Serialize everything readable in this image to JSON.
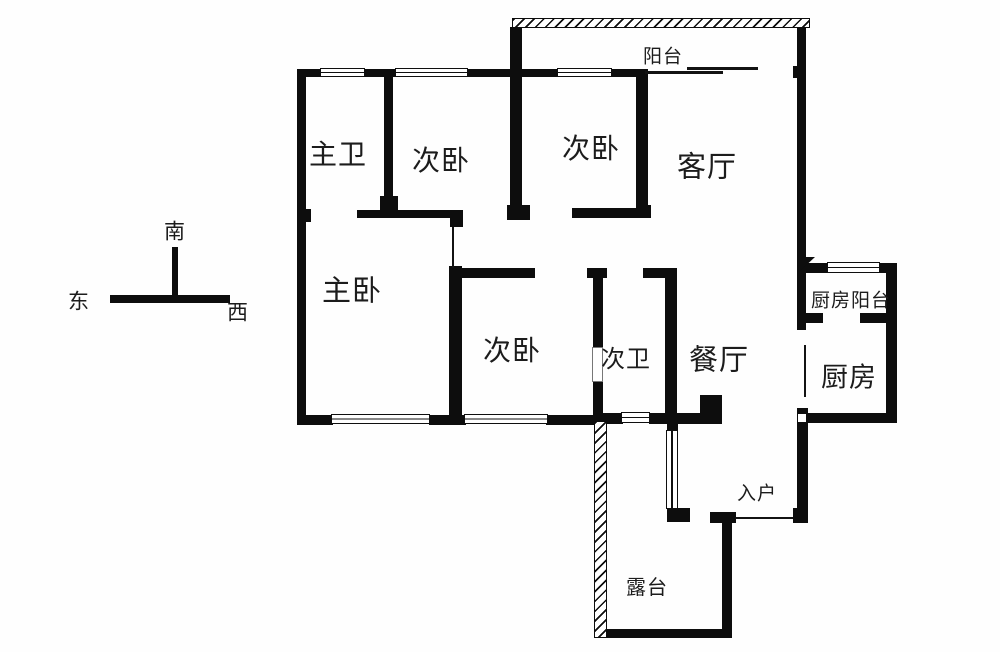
{
  "floorplan": {
    "background_color": "#fefefe",
    "wall_color": "#0d0d0d",
    "rooms": [
      {
        "id": "balcony",
        "label": "阳台",
        "x": 663,
        "y": 57,
        "fs": 19
      },
      {
        "id": "master-bath",
        "label": "主卫",
        "x": 338,
        "y": 156,
        "fs": 28
      },
      {
        "id": "bedroom-1",
        "label": "次卧",
        "x": 441,
        "y": 162,
        "fs": 28
      },
      {
        "id": "bedroom-2",
        "label": "次卧",
        "x": 591,
        "y": 150,
        "fs": 28
      },
      {
        "id": "living-room",
        "label": "客厅",
        "x": 707,
        "y": 168,
        "fs": 29
      },
      {
        "id": "master-bedroom",
        "label": "主卧",
        "x": 352,
        "y": 292,
        "fs": 29
      },
      {
        "id": "bedroom-3",
        "label": "次卧",
        "x": 512,
        "y": 352,
        "fs": 28
      },
      {
        "id": "second-bath",
        "label": "次卫",
        "x": 626,
        "y": 360,
        "fs": 24
      },
      {
        "id": "dining-room",
        "label": "餐厅",
        "x": 719,
        "y": 361,
        "fs": 29
      },
      {
        "id": "kitchen-balcony",
        "label": "厨房阳台",
        "x": 851,
        "y": 301,
        "fs": 19
      },
      {
        "id": "kitchen",
        "label": "厨房",
        "x": 849,
        "y": 378,
        "fs": 27
      },
      {
        "id": "entry",
        "label": "入户",
        "x": 757,
        "y": 494,
        "fs": 19
      },
      {
        "id": "terrace",
        "label": "露台",
        "x": 647,
        "y": 588,
        "fs": 20
      }
    ],
    "compass": {
      "south_label": "南",
      "east_label": "东",
      "west_label": "西",
      "south": {
        "x": 175,
        "y": 232,
        "fs": 21
      },
      "east": {
        "x": 79,
        "y": 302,
        "fs": 21
      },
      "west": {
        "x": 238,
        "y": 313,
        "fs": 21
      },
      "bars": [
        [
          172,
          247,
          6,
          50
        ],
        [
          110,
          295,
          120,
          8
        ]
      ]
    },
    "walls": [
      [
        297,
        69,
        9,
        356
      ],
      [
        297,
        209,
        14,
        13
      ],
      [
        297,
        69,
        26,
        8
      ],
      [
        363,
        69,
        34,
        8
      ],
      [
        466,
        69,
        56,
        8
      ],
      [
        510,
        27,
        12,
        181
      ],
      [
        507,
        205,
        23,
        15
      ],
      [
        522,
        69,
        37,
        8
      ],
      [
        610,
        69,
        38,
        8
      ],
      [
        636,
        72,
        12,
        138
      ],
      [
        636,
        205,
        15,
        13
      ],
      [
        384,
        69,
        9,
        133
      ],
      [
        380,
        196,
        18,
        22
      ],
      [
        357,
        210,
        106,
        8
      ],
      [
        572,
        208,
        75,
        10
      ],
      [
        793,
        66,
        13,
        12
      ],
      [
        797,
        27,
        9,
        303
      ],
      [
        797,
        408,
        11,
        115
      ],
      [
        806,
        263,
        23,
        10
      ],
      [
        878,
        263,
        19,
        10
      ],
      [
        886,
        263,
        11,
        160
      ],
      [
        806,
        313,
        17,
        10
      ],
      [
        860,
        313,
        36,
        10
      ],
      [
        806,
        413,
        91,
        10
      ],
      [
        450,
        215,
        13,
        12
      ],
      [
        449,
        266,
        13,
        159
      ],
      [
        458,
        268,
        77,
        10
      ],
      [
        587,
        268,
        20,
        10
      ],
      [
        643,
        268,
        34,
        10
      ],
      [
        593,
        272,
        10,
        76
      ],
      [
        593,
        381,
        10,
        43
      ],
      [
        665,
        272,
        12,
        151
      ],
      [
        297,
        415,
        36,
        10
      ],
      [
        429,
        415,
        37,
        10
      ],
      [
        546,
        415,
        58,
        10
      ],
      [
        603,
        413,
        20,
        11
      ],
      [
        649,
        413,
        73,
        11
      ],
      [
        700,
        395,
        22,
        28
      ],
      [
        594,
        629,
        137,
        9
      ],
      [
        722,
        518,
        10,
        120
      ],
      [
        667,
        423,
        11,
        9
      ],
      [
        667,
        508,
        23,
        14
      ],
      [
        710,
        512,
        26,
        11
      ],
      [
        793,
        508,
        15,
        15
      ]
    ],
    "hatched_walls": [
      [
        512,
        18,
        298,
        10
      ],
      [
        594,
        421,
        13,
        217
      ]
    ],
    "windows": [
      {
        "r": [
          320,
          68,
          45,
          9
        ],
        "o": "h"
      },
      {
        "r": [
          395,
          68,
          73,
          9
        ],
        "o": "h"
      },
      {
        "r": [
          557,
          68,
          55,
          9
        ],
        "o": "h"
      },
      {
        "r": [
          827,
          262,
          53,
          11
        ],
        "o": "h"
      },
      {
        "r": [
          331,
          414,
          99,
          10
        ],
        "o": "h"
      },
      {
        "r": [
          464,
          414,
          84,
          10
        ],
        "o": "h"
      },
      {
        "r": [
          621,
          412,
          29,
          11
        ],
        "o": "h"
      },
      {
        "r": [
          666,
          430,
          12,
          79
        ],
        "o": "v"
      }
    ],
    "thin_lines": [
      [
        645,
        71,
        78,
        3
      ],
      [
        687,
        67,
        71,
        3
      ],
      [
        735,
        517,
        58,
        2
      ],
      [
        804,
        345,
        2,
        52
      ],
      [
        452,
        227,
        2,
        41
      ]
    ],
    "door_openings": [
      [
        592,
        347,
        11,
        35
      ]
    ],
    "white_patches": [
      [
        798,
        414,
        8,
        8
      ]
    ],
    "corner_marks": [
      [
        800,
        257,
        15,
        14
      ]
    ]
  }
}
